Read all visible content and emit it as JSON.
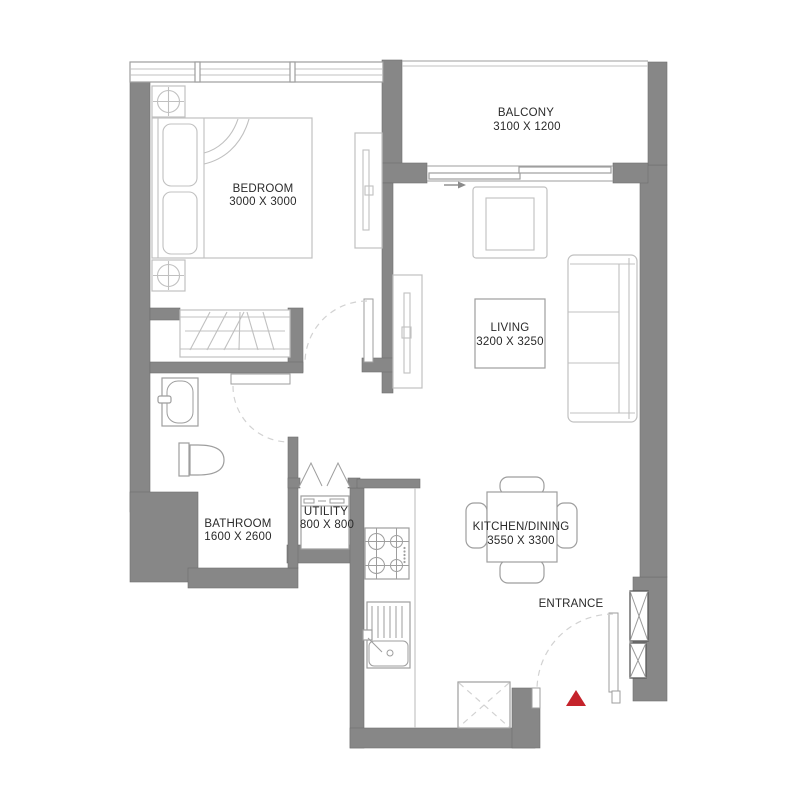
{
  "plan": {
    "rooms": [
      {
        "id": "bedroom",
        "label": "BEDROOM",
        "dims": "3000 X 3000"
      },
      {
        "id": "balcony",
        "label": "BALCONY",
        "dims": "3100 X 1200"
      },
      {
        "id": "living",
        "label": "LIVING",
        "dims": "3200 X 3250"
      },
      {
        "id": "kitchen-dining",
        "label": "KITCHEN/DINING",
        "dims": "3550 X 3300"
      },
      {
        "id": "bathroom",
        "label": "BATHROOM",
        "dims": "1600 X 2600"
      },
      {
        "id": "utility",
        "label": "UTILITY",
        "dims": "800 X 800"
      }
    ],
    "entrance_label": "ENTRANCE",
    "colors": {
      "wall": "#878787",
      "furniture_line": "#c0c0c0",
      "fixture_line": "#9e9e9e",
      "arc": "#d2d2d2",
      "text": "#2a2a2a",
      "entrance_marker": "#c5232b",
      "background": "#ffffff"
    }
  }
}
